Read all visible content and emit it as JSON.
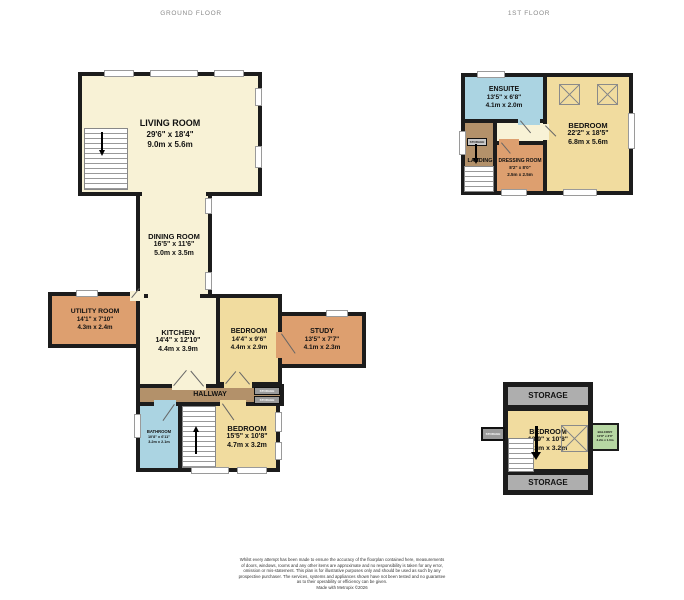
{
  "header": {
    "ground_floor": "GROUND FLOOR",
    "first_floor": "1ST FLOOR"
  },
  "ground_floor": {
    "living_room": {
      "name": "LIVING ROOM",
      "imperial": "29'6\" x 18'4\"",
      "metric": "9.0m x 5.6m"
    },
    "dining_room": {
      "name": "DINING ROOM",
      "imperial": "16'5\" x 11'6\"",
      "metric": "5.0m x 3.5m"
    },
    "utility_room": {
      "name": "UTILITY ROOM",
      "imperial": "14'1\" x 7'10\"",
      "metric": "4.3m x 2.4m"
    },
    "kitchen": {
      "name": "KITCHEN",
      "imperial": "14'4\" x 12'10\"",
      "metric": "4.4m x 3.9m"
    },
    "bedroom_mid": {
      "name": "BEDROOM",
      "imperial": "14'4\" x 9'6\"",
      "metric": "4.4m x 2.9m"
    },
    "study": {
      "name": "STUDY",
      "imperial": "13'5\" x 7'7\"",
      "metric": "4.1m x 2.3m"
    },
    "hallway": {
      "name": "HALLWAY"
    },
    "bathroom": {
      "name": "BATHROOM",
      "imperial": "10'8\" x 6'11\"",
      "metric": "3.2m x 2.1m"
    },
    "bedroom_bottom": {
      "name": "BEDROOM",
      "imperial": "15'5\" x 10'8\"",
      "metric": "4.7m x 3.2m"
    },
    "storage_a": "STORAGE",
    "storage_b": "STORAGE"
  },
  "first_floor": {
    "ensuite": {
      "name": "ENSUITE",
      "imperial": "13'5\" x 6'8\"",
      "metric": "4.1m x 2.0m"
    },
    "bedroom": {
      "name": "BEDROOM",
      "imperial": "22'2\" x 18'5\"",
      "metric": "6.8m x 5.6m"
    },
    "landing": {
      "name": "LANDING"
    },
    "dressing_room": {
      "name": "DRESSING ROOM",
      "imperial": "8'2\" x 8'0\"",
      "metric": "2.5m x 2.5m"
    },
    "cupboard": "STORAGE"
  },
  "second_floor": {
    "storage_top": "STORAGE",
    "storage_bottom": "STORAGE",
    "storage_left": "STORAGE",
    "bedroom": {
      "name": "BEDROOM",
      "imperial": "13'9\" x 10'8\"",
      "metric": "4.2m x 3.2m"
    },
    "balcony": {
      "name": "BALCONY",
      "imperial": "10'8\" x 3'3\"",
      "metric": "3.2m x 1.0m"
    }
  },
  "footer": {
    "lines": [
      "Whilst every attempt has been made to ensure the accuracy of the floorplan contained here, measurements",
      "of doors, windows, rooms and any other items are approximate and no responsibility is taken for any error,",
      "omission or mis-statement. This plan is for illustrative purposes only and should be used as such by any",
      "prospective purchaser. The services, systems and appliances shown have not been tested and no guarantee",
      "as to their operability or efficiency can be given."
    ],
    "credit": "Made with Metropix ©2026"
  },
  "colors": {
    "wall": "#1c1c1c",
    "room_cream": "#f8f2d6",
    "room_yellow": "#f1dc9f",
    "room_orange": "#dd9f6f",
    "hall_brown": "#b3916a",
    "bath_blue": "#abd4e2",
    "storage_grey": "#aeaeae",
    "balcony_green": "#b7d7a3"
  }
}
